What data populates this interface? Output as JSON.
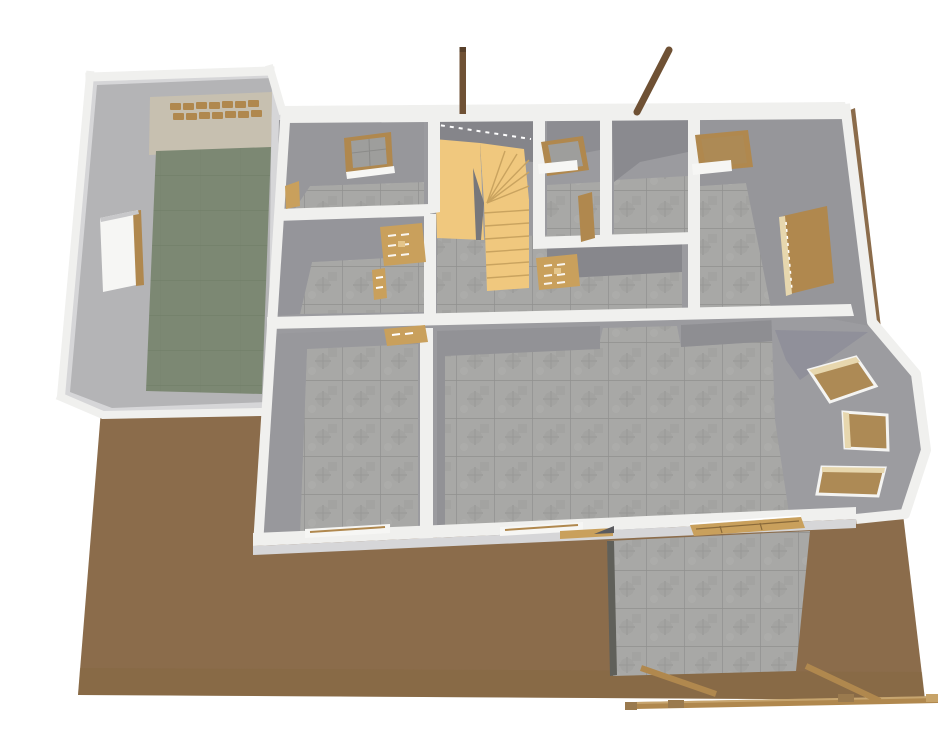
{
  "view": {
    "type": "3d-floor-plan-render",
    "description": "Overhead 3D view of a single-storey house model with garage, winder staircase, bay window and rear patio on a brown lot"
  },
  "colors": {
    "background": "#ffffff",
    "ground": "#8b6c4b",
    "ground_shade": "#83663f",
    "wall_cap": "#f0f0ee",
    "wall_outer": "#d6d6d8",
    "wall_face": "#9b9b9f",
    "wall_face_dark": "#8c8c90",
    "tile_base": "#a8a8a6",
    "tile_grout": "#8e8e8c",
    "garage_floor": "#7c8873",
    "garage_floor_line": "#6e7a65",
    "garage_wall": "#c7c0b0",
    "stair": "#f0c87e",
    "stair_line": "#c9a35f",
    "wood": "#b0884e",
    "wood_light": "#e7d7ae",
    "wood_dark": "#6f5134",
    "door_flat": "#c9a05c",
    "glass_brown": "#ad8a55",
    "sill_white": "#f6f6f4"
  },
  "objects": {
    "terrain": "earth lot",
    "garage": [
      "garage-door",
      "garage-side-window"
    ],
    "staircase": "L-shaped winder stair with landing",
    "bay_window_count": "3",
    "rear_posts_count": "2",
    "ground_beams_count": "3"
  }
}
